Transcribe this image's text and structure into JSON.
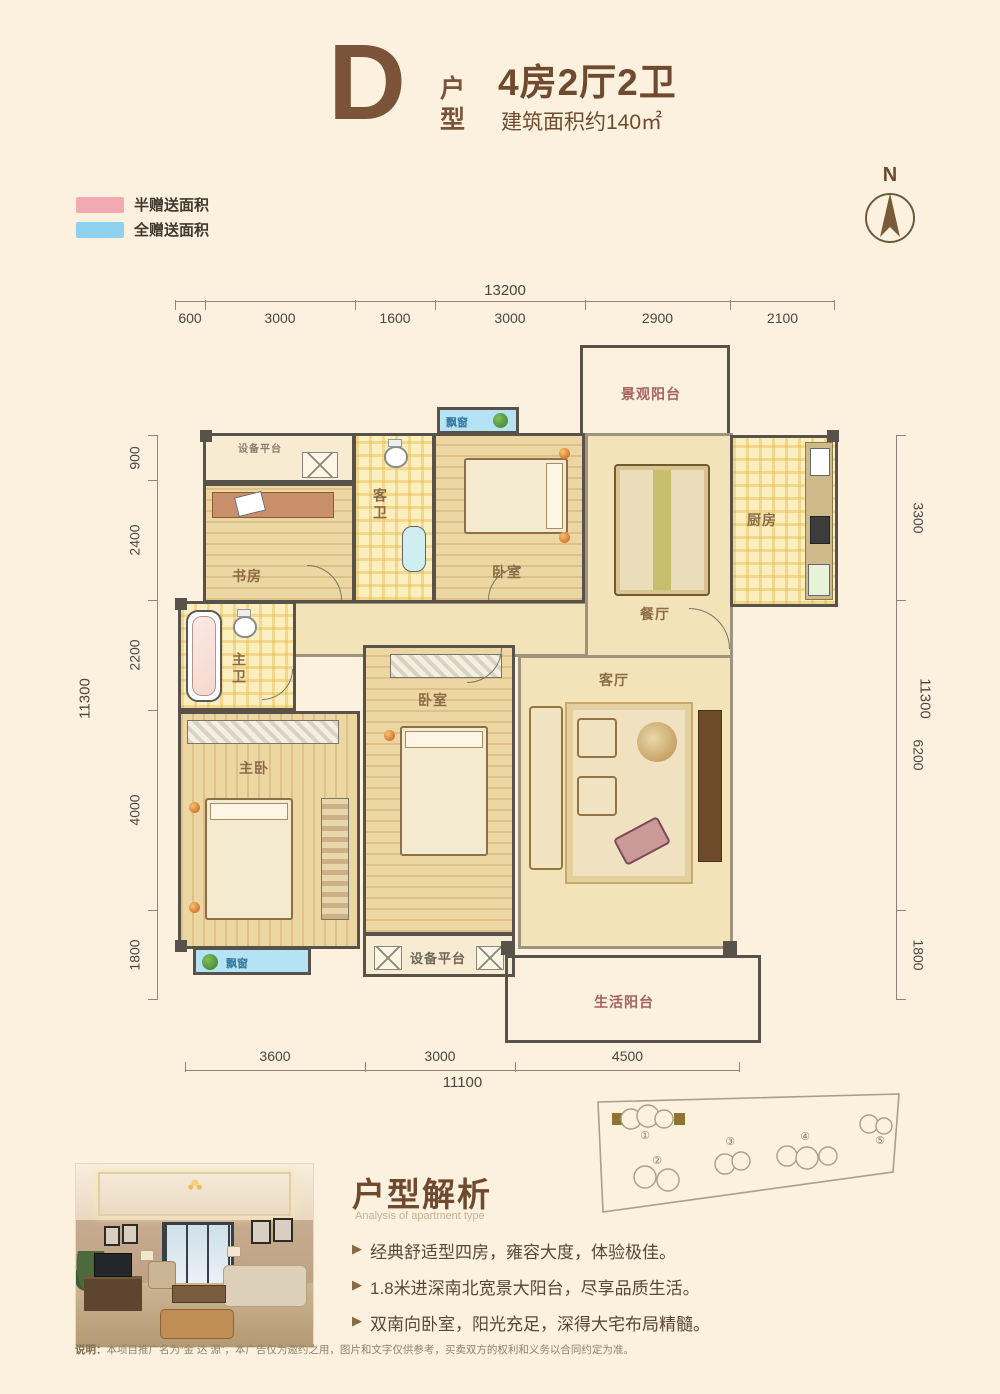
{
  "header": {
    "type_letter": "D",
    "type_word_1": "户",
    "type_word_2": "型",
    "title": "4房2厅2卫",
    "area": "建筑面积约140㎡"
  },
  "legend": {
    "items": [
      {
        "label": "半赠送面积",
        "color": "#f2aab2"
      },
      {
        "label": "全赠送面积",
        "color": "#8fd2f0"
      }
    ]
  },
  "compass": {
    "label": "N"
  },
  "dimensions": {
    "top": {
      "total": "13200",
      "segments": [
        "600",
        "3000",
        "1600",
        "3000",
        "2900",
        "2100"
      ]
    },
    "left": {
      "total": "11300",
      "segments": [
        "900",
        "2400",
        "2200",
        "4000",
        "1800"
      ]
    },
    "right": {
      "total": "11300",
      "segments": [
        "3300",
        "6200",
        "1800"
      ]
    },
    "bottom": {
      "total": "11100",
      "segments": [
        "3600",
        "3000",
        "4500"
      ]
    }
  },
  "floorplan": {
    "rooms": {
      "view_balcony": "景观阳台",
      "equipment_platform_top": "设备平台",
      "study": "书房",
      "guest_bath": "客卫",
      "bay_window_top": "飘窗",
      "bedroom1": "卧室",
      "dining": "餐厅",
      "kitchen": "厨房",
      "master_bath": "主卫",
      "master_bedroom": "主卧",
      "bedroom2": "卧室",
      "bay_window_bottom": "飘窗",
      "equipment_platform_bottom": "设备平台",
      "living": "客厅",
      "life_balcony": "生活阳台"
    }
  },
  "analysis": {
    "title": "户型解析",
    "subtitle": "Analysis of apartment type",
    "points": [
      "经典舒适型四房，雍容大度，体验极佳。",
      "1.8米进深南北宽景大阳台，尽享品质生活。",
      "双南向卧室，阳光充足，深得大宅布局精髓。"
    ]
  },
  "siteplan": {
    "numbers": [
      "①",
      "②",
      "③",
      "④",
      "⑤"
    ]
  },
  "footer": {
    "label": "说明：",
    "text": "本项目推广名为“金 达 源”，本广告仅为邀约之用，图片和文字仅供参考，买卖双方的权利和义务以合同约定为准。"
  }
}
